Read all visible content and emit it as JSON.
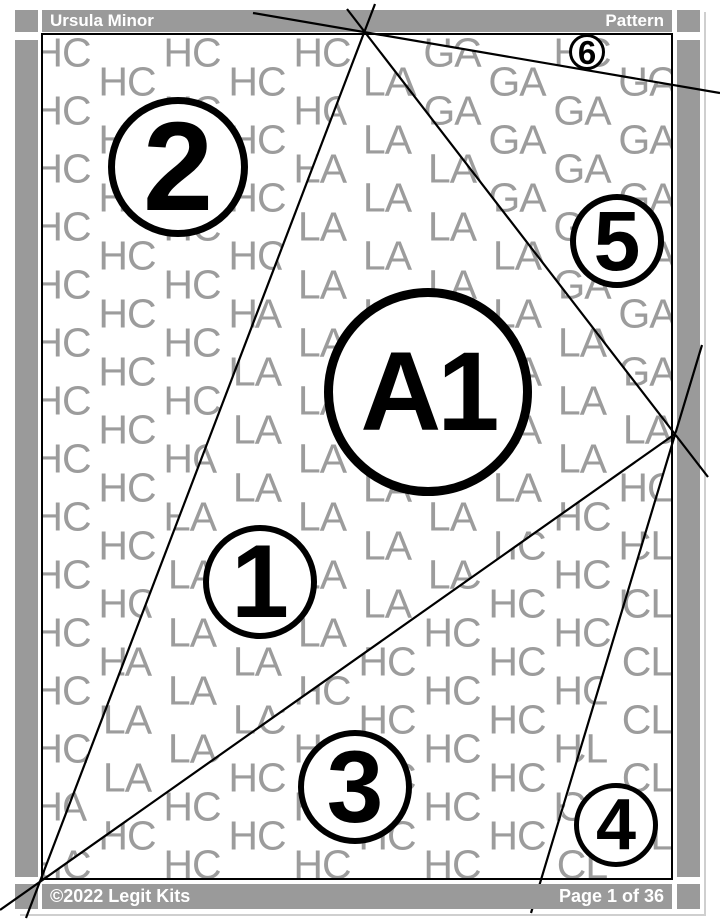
{
  "header": {
    "title": "Ursula Minor",
    "right_label": "Pattern"
  },
  "footer": {
    "copyright": "©2022 Legit Kits",
    "page_indicator": "Page 1 of 36"
  },
  "colors": {
    "bar_gray": "#9a9a9a",
    "watermark_gray": "#9c9c9c",
    "seam_black": "#000000",
    "page_edge_gray": "#cfcfcf",
    "bar_text": "#ffffff"
  },
  "pattern": {
    "watermark": {
      "font_size": 41,
      "pitch_x": 65,
      "pitch_y": 29,
      "x0": 19,
      "y0": 18,
      "cols": 10,
      "rows": 29,
      "regions": [
        {
          "code": "HC"
        },
        {
          "code": "LA",
          "polygon": [
            [
              322,
              -4
            ],
            [
              632,
              399
            ],
            [
              -3,
              847
            ]
          ]
        },
        {
          "code": "GA",
          "polygon": [
            [
              322,
              -4
            ],
            [
              629,
              50
            ],
            [
              632,
              399
            ]
          ]
        },
        {
          "code": "CL",
          "polygon": [
            [
              632,
              399
            ],
            [
              632,
              845
            ],
            [
              500,
              845
            ]
          ]
        }
      ]
    },
    "seam_lines": [
      {
        "name": "seam-top-to-bottom-left",
        "x1": 375,
        "y1": 4,
        "x2": 26,
        "y2": 918
      },
      {
        "name": "seam-top-right-shallow",
        "x1": 253,
        "y1": 13,
        "x2": 720,
        "y2": 93
      },
      {
        "name": "seam-top-to-right-vertex",
        "x1": 347,
        "y1": 9,
        "x2": 708,
        "y2": 477
      },
      {
        "name": "seam-right-vertex-down",
        "x1": 702,
        "y1": 345,
        "x2": 531,
        "y2": 913
      },
      {
        "name": "seam-bottom-left-to-right",
        "x1": 0,
        "y1": 910,
        "x2": 675,
        "y2": 434
      }
    ],
    "pieces": [
      {
        "label": "A1",
        "cx": 428,
        "cy": 392,
        "r": 104,
        "stroke": 9,
        "font_size": 112
      },
      {
        "label": "1",
        "cx": 260,
        "cy": 582,
        "r": 57,
        "stroke": 6,
        "font_size": 104
      },
      {
        "label": "2",
        "cx": 178,
        "cy": 167,
        "r": 70,
        "stroke": 7,
        "font_size": 126
      },
      {
        "label": "3",
        "cx": 355,
        "cy": 787,
        "r": 57,
        "stroke": 6,
        "font_size": 102
      },
      {
        "label": "4",
        "cx": 616,
        "cy": 825,
        "r": 42,
        "stroke": 5,
        "font_size": 72
      },
      {
        "label": "5",
        "cx": 617,
        "cy": 241,
        "r": 47,
        "stroke": 6,
        "font_size": 84
      },
      {
        "label": "6",
        "cx": 587,
        "cy": 52,
        "r": 18,
        "stroke": 3.5,
        "font_size": 33
      }
    ]
  }
}
